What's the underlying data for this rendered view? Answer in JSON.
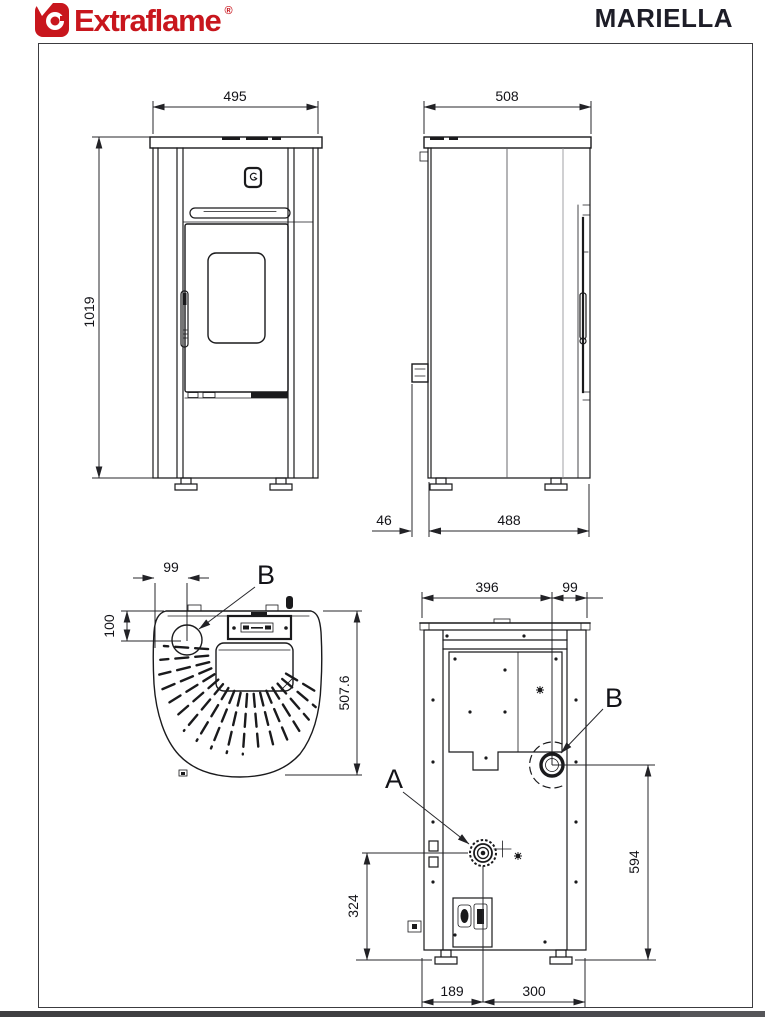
{
  "header": {
    "brand": "Extraflame",
    "registered_mark": "®",
    "model": "MARIELLA"
  },
  "colors": {
    "brand_red": "#c8161d",
    "ink": "#1a1a1c",
    "title_ink": "#1d1d27"
  },
  "views": {
    "front": {
      "dim_width": "495",
      "dim_height": "1019"
    },
    "side": {
      "dim_width": "508",
      "dim_rear_clearance": "46",
      "dim_depth": "488"
    },
    "top": {
      "dim_flue_offset_x": "99",
      "dim_flue_offset_y": "100",
      "dim_depth": "507.6",
      "flue_label": "B"
    },
    "back": {
      "dim_left_to_flue": "396",
      "dim_flue_to_edge": "99",
      "dim_flue_center_height": "594",
      "dim_intake_center_height": "324",
      "dim_edge_to_intake": "189",
      "dim_intake_to_edge": "300",
      "intake_label": "A",
      "flue_label": "B"
    }
  }
}
